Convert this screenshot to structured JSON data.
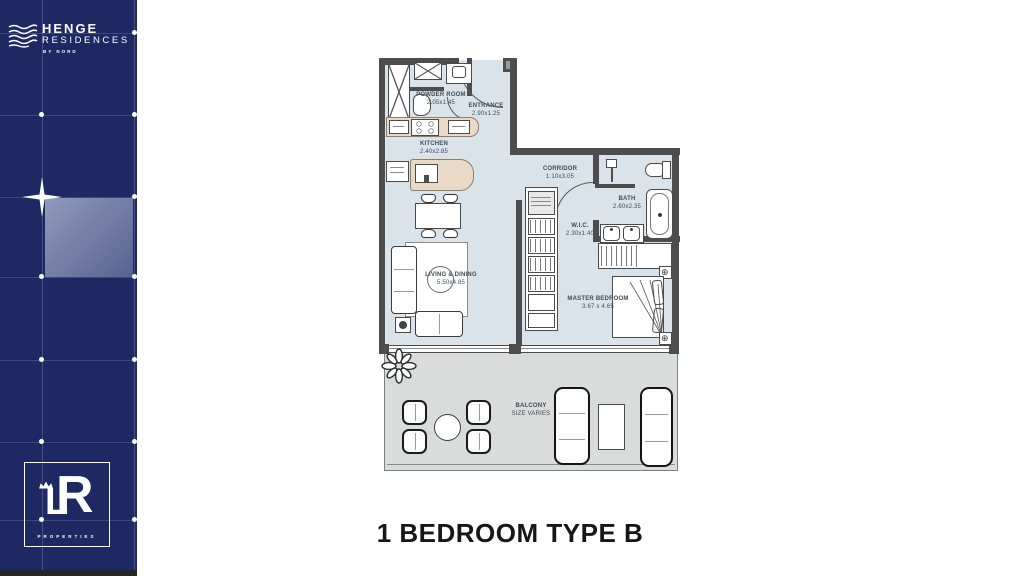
{
  "sidebar": {
    "henge_logo": {
      "name": "HENGE",
      "sub": "RESIDENCES",
      "tagline": "BY NORD"
    },
    "lr_logo": {
      "letter_l": "L",
      "letter_r": "R",
      "label": "PROPERTIES"
    }
  },
  "plan": {
    "title": "1 BEDROOM TYPE B",
    "rooms": [
      {
        "name": "POWDER ROOM",
        "dims": "2.05x1.45"
      },
      {
        "name": "ENTRANCE",
        "dims": "2.90x1.25"
      },
      {
        "name": "KITCHEN",
        "dims": "2.40x2.85"
      },
      {
        "name": "CORRIDOR",
        "dims": "1.10x3.05"
      },
      {
        "name": "W.I.C.",
        "dims": "2.30x1.40"
      },
      {
        "name": "BATH",
        "dims": "2.60x2.35"
      },
      {
        "name": "LIVING & DINING",
        "dims": "5.50x4.85"
      },
      {
        "name": "MASTER BEDROOM",
        "dims": "3.67 x 4.65"
      },
      {
        "name": "BALCONY",
        "dims": "SIZE VARIES"
      }
    ],
    "colors": {
      "sidebar_navy": "#1e2963",
      "floor": "#d9e3e9",
      "balcony": "#dadbdb",
      "wall": "#4d4d4d",
      "counter_beige": "#e9dac7",
      "label_text": "#3e4c57"
    }
  }
}
